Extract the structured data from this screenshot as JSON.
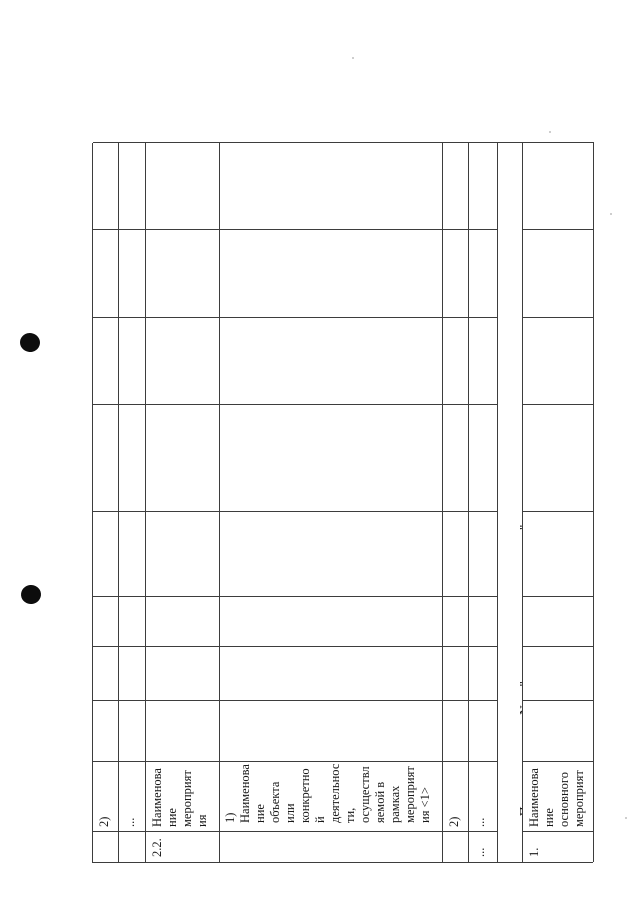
{
  "colors": {
    "page_background": "#ffffff",
    "grid_line": "#3d3d3d",
    "text": "#1a1a1a",
    "punch_hole": "#0d0d0d"
  },
  "table": {
    "rows": [
      {
        "num": "",
        "name": "2)"
      },
      {
        "num": "",
        "name": "..."
      },
      {
        "num": "2.2.",
        "name": "Наименова\nние\nмероприят\nия"
      },
      {
        "num": "",
        "name": "1)\nНаименова\nние\nобъекта\nили\nконкретно\nй\nдеятельнос\nти,\nосуществл\nяемой в\nрамках\nмероприят\nия <1>"
      },
      {
        "num": "",
        "name": "2)"
      },
      {
        "num": "...",
        "name": "..."
      },
      {
        "num": "1.",
        "name": "Наименова\nние\nосновного\nмероприят"
      }
    ],
    "subprogram": {
      "prefix": "Подпрограмма N... \"",
      "suffix": "\""
    }
  }
}
